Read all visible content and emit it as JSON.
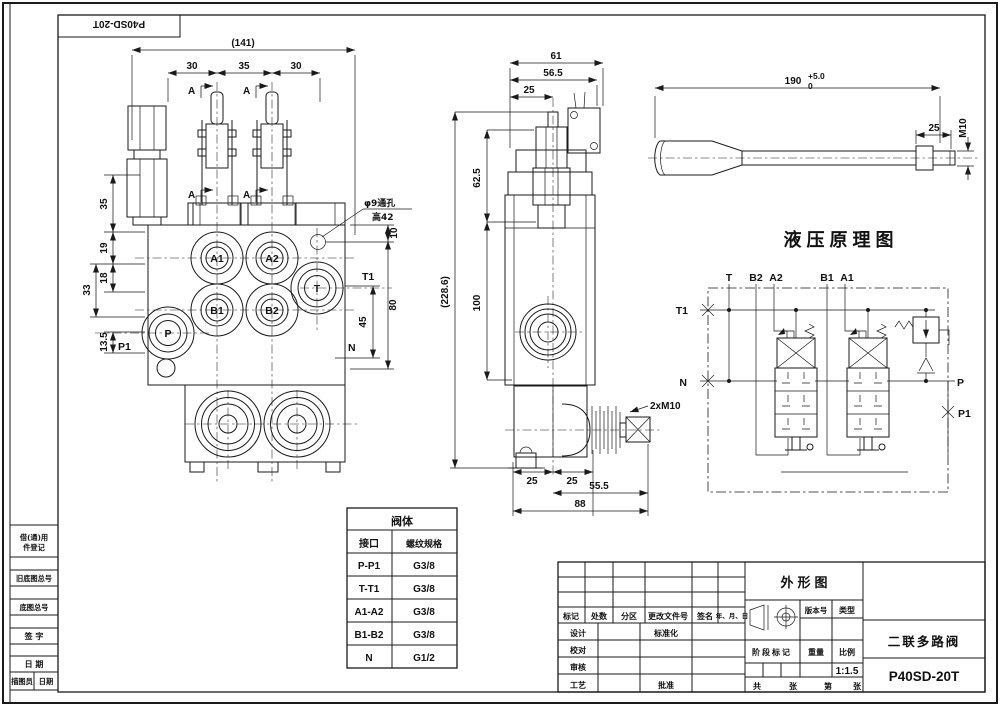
{
  "frame": {
    "label": "P40SD-20T"
  },
  "strip": {
    "row1a": "借(通)用",
    "row1b": "件登记",
    "row3": "旧底图总号",
    "row5": "底图总号",
    "row7": "签  字",
    "row9": "日  期",
    "row10a": "描图员",
    "row10b": "日期"
  },
  "front": {
    "overall": "(141)",
    "w30a": "30",
    "w35": "35",
    "w30b": "30",
    "sec_a": "A",
    "l35": "35",
    "l19": "19",
    "l18": "18",
    "l33": "33",
    "l135": "13.5",
    "r10": "10",
    "r80": "80",
    "r45": "45",
    "t1": "T1",
    "n": "N",
    "p1_label": "P1",
    "a1": "A1",
    "a2": "A2",
    "b1": "B1",
    "b2": "B2",
    "p": "P",
    "t": "T",
    "note1": "φ9通孔",
    "note2": "高42"
  },
  "side": {
    "d61": "61",
    "d565": "56.5",
    "d25top": "25",
    "d625": "62.5",
    "d2286": "(228.6)",
    "d100": "100",
    "m10": "2xM10",
    "d25a": "25",
    "d25b": "25",
    "d555": "55.5",
    "d88": "88"
  },
  "handle": {
    "d190": "190",
    "tol_hi": "+5.0",
    "tol_lo": "0",
    "d25": "25",
    "m10": "M10"
  },
  "schem": {
    "title": "液压原理图",
    "t": "T",
    "b2": "B2",
    "a2": "A2",
    "b1": "B1",
    "a1": "A1",
    "t1": "T1",
    "n": "N",
    "p": "P",
    "p1": "P1"
  },
  "spec": {
    "title": "阀体",
    "h1": "接口",
    "h2": "螺纹规格",
    "rows": [
      [
        "P-P1",
        "G3/8"
      ],
      [
        "T-T1",
        "G3/8"
      ],
      [
        "A1-A2",
        "G3/8"
      ],
      [
        "B1-B2",
        "G3/8"
      ],
      [
        "N",
        "G1/2"
      ]
    ]
  },
  "tb": {
    "mark": "标记",
    "count": "处数",
    "zone": "分区",
    "change_doc": "更改文件号",
    "sign": "签名",
    "date": "年、月、日",
    "design": "设计",
    "std": "标准化",
    "check": "校对",
    "audit": "审核",
    "process": "工艺",
    "approve": "批准",
    "outline": "外形图",
    "version": "版本号",
    "type": "类型",
    "stage": "阶段标记",
    "weight": "重量",
    "scale_label": "比例",
    "scale": "1:1.5",
    "total": "共",
    "sheet1": "张",
    "page": "第",
    "sheet2": "张",
    "product": "二联多路阀",
    "model": "P40SD-20T"
  }
}
